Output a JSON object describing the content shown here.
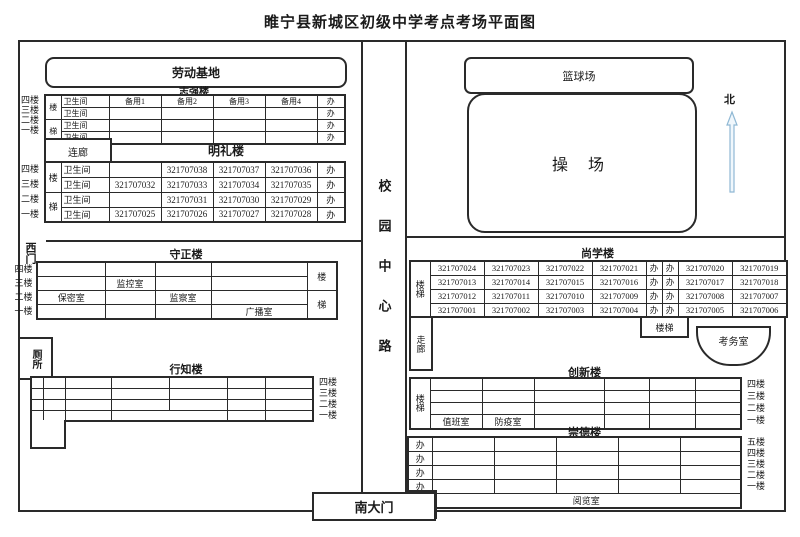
{
  "page_title": "睢宁县新城区初级中学考点考场平面图",
  "road": {
    "label": "校园中心路"
  },
  "compass": {
    "north": "北"
  },
  "gates": {
    "south": "南大门",
    "west": "西门"
  },
  "facilities": {
    "labor_base": "劳动基地",
    "basketball": "篮球场",
    "playground": "操  场",
    "toilet": "厕所"
  },
  "zhiqiang": {
    "title": "志强楼",
    "floors": [
      "四楼",
      "三楼",
      "二楼",
      "一楼"
    ],
    "stairs": [
      "楼",
      "梯"
    ],
    "wc": "卫生间",
    "office": "办",
    "rows": [
      [
        "备用1",
        "备用2",
        "备用3",
        "备用4"
      ],
      [
        "",
        "",
        "",
        ""
      ],
      [
        "",
        "",
        "",
        ""
      ],
      [
        "",
        "",
        "",
        ""
      ]
    ]
  },
  "mingli": {
    "title": "明礼楼",
    "corridor_link": "连廊",
    "floors": [
      "四楼",
      "三楼",
      "二楼",
      "一楼"
    ],
    "stairs": [
      "楼",
      "梯"
    ],
    "wc": "卫生间",
    "office": "办",
    "rows": [
      [
        "",
        "321707038",
        "321707037",
        "321707036"
      ],
      [
        "321707032",
        "321707033",
        "321707034",
        "321707035"
      ],
      [
        "",
        "321707031",
        "321707030",
        "321707029"
      ],
      [
        "321707025",
        "321707026",
        "321707027",
        "321707028"
      ]
    ]
  },
  "shouzheng": {
    "title": "守正楼",
    "floors": [
      "四楼",
      "三楼",
      "二楼",
      "一楼"
    ],
    "stairs": [
      "楼",
      "梯"
    ],
    "rows": [
      [
        "",
        "",
        "",
        ""
      ],
      [
        "",
        "监控室",
        "",
        ""
      ],
      [
        "保密室",
        "",
        "监察室",
        ""
      ],
      [
        "",
        "",
        "",
        "广播室"
      ]
    ]
  },
  "xingzhi": {
    "title": "行知楼",
    "floors": [
      "四楼",
      "三楼",
      "二楼",
      "一楼"
    ]
  },
  "shangxue": {
    "title": "尚学楼",
    "stairs": "楼梯",
    "corridor": "走廊",
    "stair_box": "楼梯",
    "exam_office": "考务室",
    "rows": [
      [
        "321707024",
        "321707023",
        "321707022",
        "321707021",
        "办",
        "办",
        "321707020",
        "321707019"
      ],
      [
        "321707013",
        "321707014",
        "321707015",
        "321707016",
        "办",
        "办",
        "321707017",
        "321707018"
      ],
      [
        "321707012",
        "321707011",
        "321707010",
        "321707009",
        "办",
        "办",
        "321707008",
        "321707007"
      ],
      [
        "321707001",
        "321707002",
        "321707003",
        "321707004",
        "办",
        "办",
        "321707005",
        "321707006"
      ]
    ]
  },
  "chuangxin": {
    "title": "创新楼",
    "stairs": "楼梯",
    "floors": [
      "四楼",
      "三楼",
      "二楼",
      "一楼"
    ],
    "duty_room": "值班室",
    "epidemic_room": "防疫室"
  },
  "chongde": {
    "title": "崇德楼",
    "floors": [
      "五楼",
      "四楼",
      "三楼",
      "二楼",
      "一楼"
    ],
    "office": "办",
    "reading_room": "阅览室"
  }
}
